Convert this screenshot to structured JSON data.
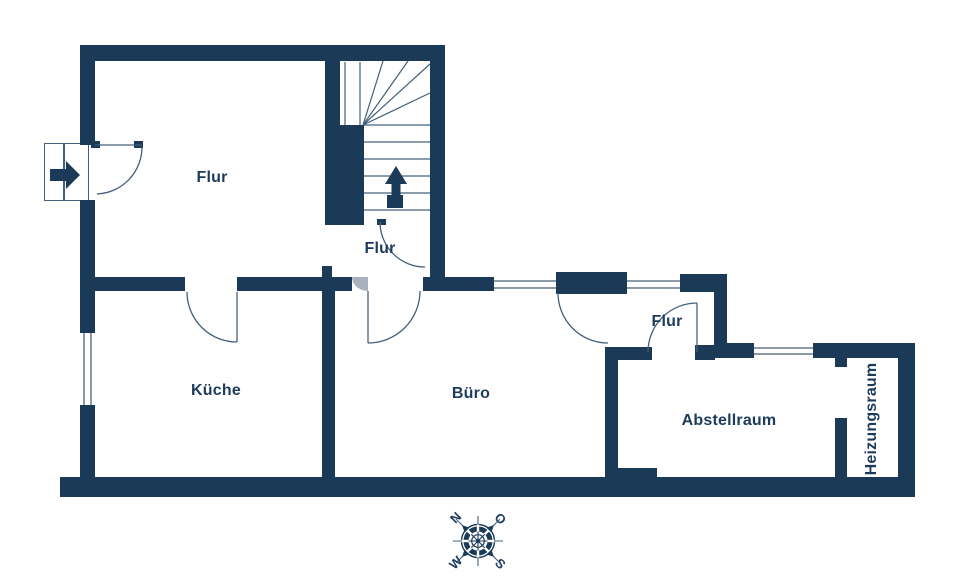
{
  "rooms": [
    {
      "id": "flur-main",
      "label": "Flur"
    },
    {
      "id": "flur-landing",
      "label": "Flur"
    },
    {
      "id": "kueche",
      "label": "Küche"
    },
    {
      "id": "buero",
      "label": "Büro"
    },
    {
      "id": "flur-small",
      "label": "Flur"
    },
    {
      "id": "abstellraum",
      "label": "Abstellraum"
    },
    {
      "id": "heizungsraum",
      "label": "Heizungsraum"
    }
  ],
  "compass": {
    "north": "N",
    "east": "O",
    "south": "S",
    "west": "W"
  },
  "colors": {
    "wall": "#1b3a58",
    "label": "#1d3b5c",
    "door_arc": "#44607c",
    "window_line": "#8d9aa8",
    "door_leaf_gray": "#a9b1bc",
    "background": "#ffffff"
  }
}
